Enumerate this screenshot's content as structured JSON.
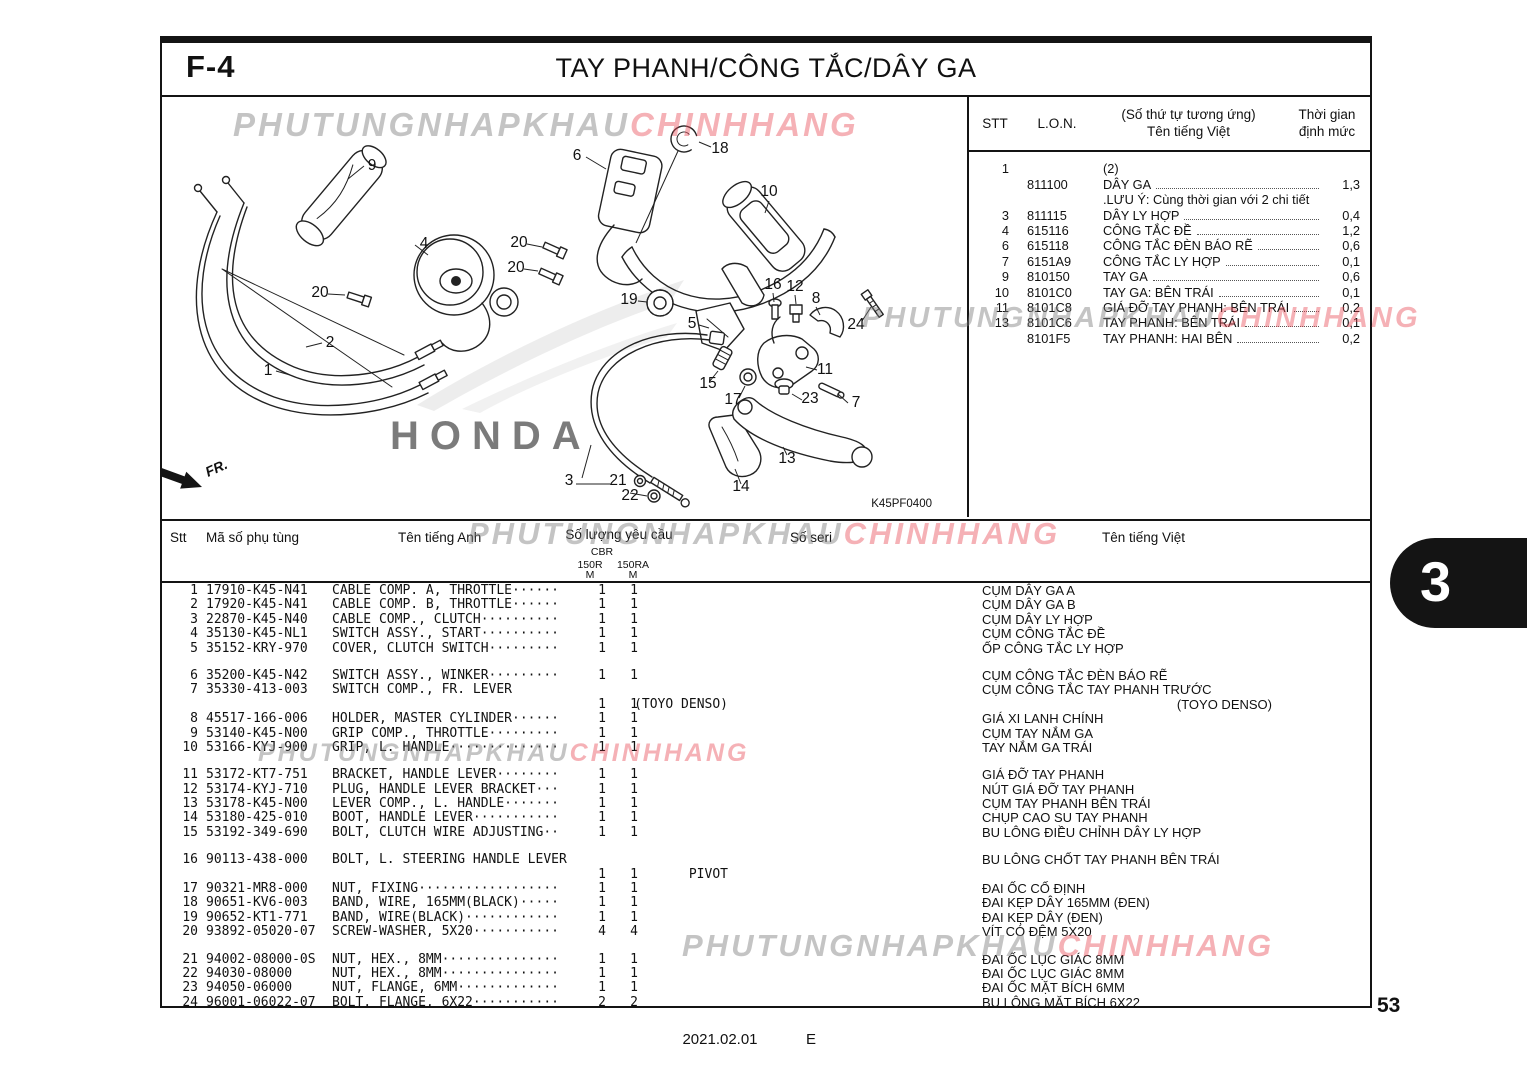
{
  "page": {
    "code": "F-4",
    "title": "TAY PHANH/CÔNG TẮC/DÂY GA",
    "page_number": "53",
    "tab_number": "3",
    "footer_date": "2021.02.01",
    "footer_rev": "E",
    "diagram_code": "K45PF0400",
    "fr_label": "FR."
  },
  "watermark": {
    "gray_text": "PHUTUNGNHAPKHAU",
    "pink_text": "CHINHHANG",
    "gray_color": "#7d7d7d",
    "pink_color": "#e74650",
    "honda_label": "HONDA"
  },
  "ref_table": {
    "headers": {
      "stt": "STT",
      "lon": "L.O.N.",
      "name_line1": "(Số thứ tự tương ứng)",
      "name_line2": "Tên tiếng Việt",
      "time_line1": "Thời gian",
      "time_line2": "định mức"
    },
    "rows": [
      {
        "stt": "1",
        "lon": "",
        "name": "(2)",
        "time": ""
      },
      {
        "stt": "",
        "lon": "811100",
        "name": "DÂY GA",
        "time": "1,3"
      },
      {
        "stt": "",
        "lon": "",
        "name": ".LƯU Ý: Cùng thời gian với 2 chi tiết",
        "time": ""
      },
      {
        "stt": "3",
        "lon": "811115",
        "name": "DÂY LY HỢP",
        "time": "0,4"
      },
      {
        "stt": "4",
        "lon": "615116",
        "name": "CÔNG TẮC ĐỀ",
        "time": "1,2"
      },
      {
        "stt": "6",
        "lon": "615118",
        "name": "CÔNG TẮC ĐÈN BÁO RẼ",
        "time": "0,6"
      },
      {
        "stt": "7",
        "lon": "6151A9",
        "name": "CÔNG TẮC LY HỢP",
        "time": "0,1"
      },
      {
        "stt": "9",
        "lon": "810150",
        "name": "TAY GA",
        "time": "0,6"
      },
      {
        "stt": "10",
        "lon": "8101C0",
        "name": "TAY GA: BÊN TRÁI",
        "time": "0,1"
      },
      {
        "stt": "11",
        "lon": "8101C8",
        "name": "GIÁ ĐỠ TAY PHANH: BÊN TRÁI",
        "time": "0,2"
      },
      {
        "stt": "13",
        "lon": "8101C6",
        "name": "TAY PHANH: BÊN TRÁI",
        "time": "0,1"
      },
      {
        "stt": "",
        "lon": "8101F5",
        "name": "TAY PHANH: HAI BÊN",
        "time": "0,2"
      }
    ]
  },
  "parts_table": {
    "headers": {
      "stt": "Stt",
      "code": "Mã số phụ tùng",
      "en": "Tên tiếng Anh",
      "qty": "Số lượng yêu cầu",
      "qty_model": "CBR",
      "qty_col1": "150R",
      "qty_col2": "150RA",
      "qty_sub": "M",
      "serial": "Số seri",
      "vi": "Tên tiếng Việt"
    },
    "lines": [
      {
        "stt": "1",
        "code": "17910-K45-N41",
        "en": "CABLE COMP. A, THROTTLE······",
        "q1": "1",
        "q2": "1",
        "vi": "CỤM DÂY GA A"
      },
      {
        "stt": "2",
        "code": "17920-K45-N41",
        "en": "CABLE COMP. B, THROTTLE······",
        "q1": "1",
        "q2": "1",
        "vi": "CỤM DÂY GA B"
      },
      {
        "stt": "3",
        "code": "22870-K45-N40",
        "en": "CABLE COMP., CLUTCH··········",
        "q1": "1",
        "q2": "1",
        "vi": "CỤM DÂY LY HỢP"
      },
      {
        "stt": "4",
        "code": "35130-K45-NL1",
        "en": "SWITCH ASSY., START··········",
        "q1": "1",
        "q2": "1",
        "vi": "CỤM CÔNG TẮC ĐỀ"
      },
      {
        "stt": "5",
        "code": "35152-KRY-970",
        "en": "COVER, CLUTCH SWITCH·········",
        "q1": "1",
        "q2": "1",
        "vi": "ỐP CÔNG TẮC LY HỢP"
      },
      {
        "spacer": true
      },
      {
        "stt": "6",
        "code": "35200-K45-N42",
        "en": "SWITCH ASSY., WINKER·········",
        "q1": "1",
        "q2": "1",
        "vi": "CỤM CÔNG TẮC ĐÈN BÁO RẼ"
      },
      {
        "stt": "7",
        "code": "35330-413-003",
        "en": "SWITCH COMP., FR. LEVER",
        "vi": "CỤM CÔNG TẮC TAY PHANH TRƯỚC"
      },
      {
        "en": "(TOYO DENSO)",
        "en_right": true,
        "q1": "1",
        "q2": "1",
        "vi": "(TOYO DENSO)",
        "vi_right": true
      },
      {
        "stt": "8",
        "code": "45517-166-006",
        "en": "HOLDER, MASTER CYLINDER······",
        "q1": "1",
        "q2": "1",
        "vi": "GIÁ XI LANH CHÍNH"
      },
      {
        "stt": "9",
        "code": "53140-K45-N00",
        "en": "GRIP COMP., THROTTLE·········",
        "q1": "1",
        "q2": "1",
        "vi": "CỤM TAY NẮM GA"
      },
      {
        "stt": "10",
        "code": "53166-KYJ-900",
        "en": "GRIP, L. HANDLE··············",
        "q1": "1",
        "q2": "1",
        "vi": "TAY NẮM GA TRÁI"
      },
      {
        "spacer": true
      },
      {
        "stt": "11",
        "code": "53172-KT7-751",
        "en": "BRACKET, HANDLE LEVER········",
        "q1": "1",
        "q2": "1",
        "vi": "GIÁ ĐỠ TAY PHANH"
      },
      {
        "stt": "12",
        "code": "53174-KYJ-710",
        "en": "PLUG, HANDLE LEVER BRACKET···",
        "q1": "1",
        "q2": "1",
        "vi": "NÚT GIÁ ĐỠ TAY PHANH"
      },
      {
        "stt": "13",
        "code": "53178-K45-N00",
        "en": "LEVER COMP., L. HANDLE·······",
        "q1": "1",
        "q2": "1",
        "vi": "CỤM TAY PHANH BÊN TRÁI"
      },
      {
        "stt": "14",
        "code": "53180-425-010",
        "en": "BOOT, HANDLE LEVER···········",
        "q1": "1",
        "q2": "1",
        "vi": "CHỤP CAO SU TAY PHANH"
      },
      {
        "stt": "15",
        "code": "53192-349-690",
        "en": "BOLT, CLUTCH WIRE ADJUSTING··",
        "q1": "1",
        "q2": "1",
        "vi": "BU LÔNG ĐIỀU CHỈNH DÂY LY HỢP"
      },
      {
        "spacer": true
      },
      {
        "stt": "16",
        "code": "90113-438-000",
        "en": "BOLT, L. STEERING HANDLE LEVER",
        "vi": "BU LÔNG CHỐT TAY PHANH BÊN TRÁI"
      },
      {
        "en": "PIVOT",
        "en_right": true,
        "q1": "1",
        "q2": "1"
      },
      {
        "stt": "17",
        "code": "90321-MR8-000",
        "en": "NUT, FIXING··················",
        "q1": "1",
        "q2": "1",
        "vi": "ĐAI ỐC CỐ ĐỊNH"
      },
      {
        "stt": "18",
        "code": "90651-KV6-003",
        "en": "BAND, WIRE, 165MM(BLACK)·····",
        "q1": "1",
        "q2": "1",
        "vi": "ĐAI KẸP DÂY 165MM (ĐEN)"
      },
      {
        "stt": "19",
        "code": "90652-KT1-771",
        "en": "BAND, WIRE(BLACK)············",
        "q1": "1",
        "q2": "1",
        "vi": "ĐAI KẸP DÂY (ĐEN)"
      },
      {
        "stt": "20",
        "code": "93892-05020-07",
        "en": "SCREW-WASHER, 5X20···········",
        "q1": "4",
        "q2": "4",
        "vi": "VÍT CÓ ĐỆM 5X20"
      },
      {
        "spacer": true
      },
      {
        "stt": "21",
        "code": "94002-08000-0S",
        "en": "NUT, HEX., 8MM···············",
        "q1": "1",
        "q2": "1",
        "vi": "ĐAI ỐC LỤC GIÁC 8MM"
      },
      {
        "stt": "22",
        "code": "94030-08000",
        "en": "NUT, HEX., 8MM···············",
        "q1": "1",
        "q2": "1",
        "vi": "ĐAI ỐC LỤC GIÁC 8MM"
      },
      {
        "stt": "23",
        "code": "94050-06000",
        "en": "NUT, FLANGE, 6MM·············",
        "q1": "1",
        "q2": "1",
        "vi": "ĐAI ỐC MẶT BÍCH 6MM"
      },
      {
        "stt": "24",
        "code": "96001-06022-07",
        "en": "BOLT, FLANGE, 6X22···········",
        "q1": "2",
        "q2": "2",
        "vi": "BU LÔNG MẶT BÍCH 6X22"
      }
    ]
  },
  "diagram": {
    "callouts": [
      {
        "n": "9",
        "x": 210,
        "y": 73
      },
      {
        "n": "6",
        "x": 415,
        "y": 63
      },
      {
        "n": "18",
        "x": 558,
        "y": 56
      },
      {
        "n": "10",
        "x": 607,
        "y": 99
      },
      {
        "n": "4",
        "x": 262,
        "y": 151
      },
      {
        "n": "20",
        "x": 357,
        "y": 150
      },
      {
        "n": "20",
        "x": 354,
        "y": 175
      },
      {
        "n": "20",
        "x": 158,
        "y": 200
      },
      {
        "n": "2",
        "x": 168,
        "y": 250
      },
      {
        "n": "1",
        "x": 106,
        "y": 278
      },
      {
        "n": "19",
        "x": 467,
        "y": 207
      },
      {
        "n": "5",
        "x": 530,
        "y": 231
      },
      {
        "n": "16",
        "x": 611,
        "y": 192
      },
      {
        "n": "12",
        "x": 633,
        "y": 194
      },
      {
        "n": "8",
        "x": 654,
        "y": 206
      },
      {
        "n": "24",
        "x": 694,
        "y": 232
      },
      {
        "n": "11",
        "x": 663,
        "y": 277
      },
      {
        "n": "15",
        "x": 546,
        "y": 291
      },
      {
        "n": "17",
        "x": 571,
        "y": 307
      },
      {
        "n": "23",
        "x": 648,
        "y": 306
      },
      {
        "n": "7",
        "x": 694,
        "y": 310
      },
      {
        "n": "3",
        "x": 407,
        "y": 388
      },
      {
        "n": "21",
        "x": 456,
        "y": 388
      },
      {
        "n": "22",
        "x": 468,
        "y": 403
      },
      {
        "n": "14",
        "x": 579,
        "y": 394
      },
      {
        "n": "13",
        "x": 625,
        "y": 366
      }
    ]
  }
}
